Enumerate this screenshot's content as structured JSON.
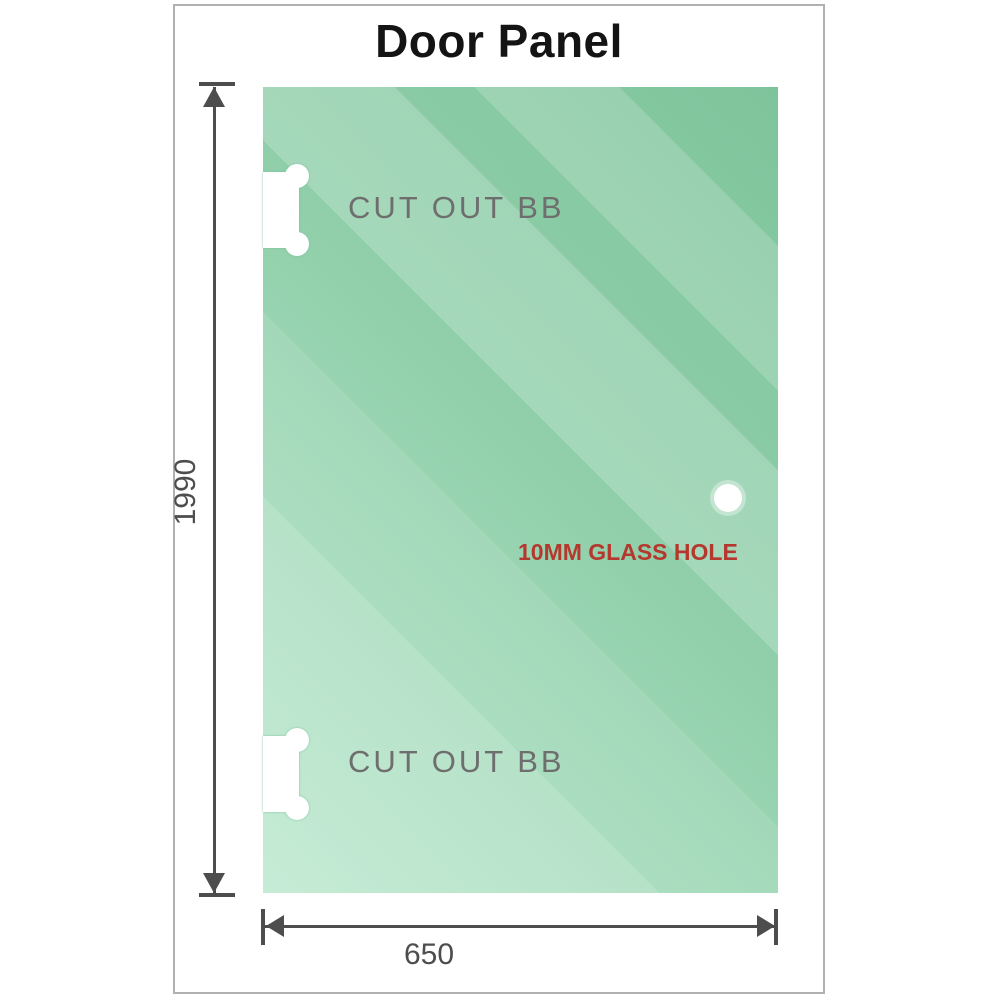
{
  "title": "Door Panel",
  "panel": {
    "cutout_top_label": "CUT OUT BB",
    "cutout_bottom_label": "CUT OUT BB",
    "glass_hole_label": "10MM GLASS HOLE"
  },
  "dimensions": {
    "height_mm": "1990",
    "width_mm": "650"
  },
  "colors": {
    "title": "#141414",
    "frame_border": "#b0b0b0",
    "glass_dark": "#7ec49b",
    "glass_mid": "#90cfaa",
    "glass_light": "#b6e6ca",
    "dimension": "#4d4d4d",
    "cutout_label": "#6e6e6e",
    "hole_label": "#b5382e"
  }
}
